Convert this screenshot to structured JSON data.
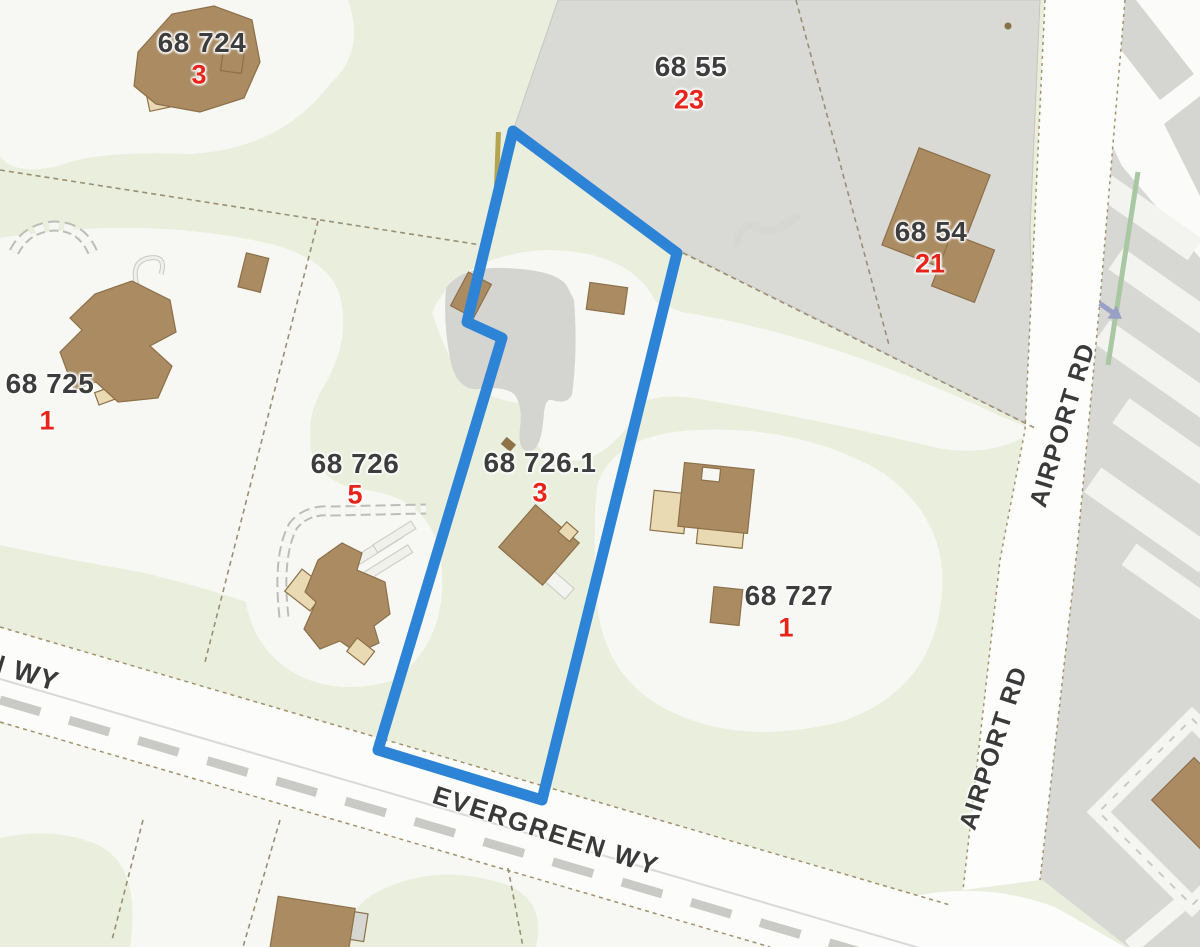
{
  "map": {
    "type": "cadastral-parcel-map",
    "selected_parcel": {
      "id": "68 726.1",
      "outline_color": "#2d84d6"
    },
    "parcels": [
      {
        "id": "68 724",
        "unit_count": "3"
      },
      {
        "id": "68 55",
        "unit_count": "23"
      },
      {
        "id": "68 54",
        "unit_count": "21"
      },
      {
        "id": "68 725",
        "unit_count": "1"
      },
      {
        "id": "68 726",
        "unit_count": "5"
      },
      {
        "id": "68 726.1",
        "unit_count": "3"
      },
      {
        "id": "68 727",
        "unit_count": "1"
      }
    ],
    "roads": [
      {
        "name": "AIRPORT RD"
      },
      {
        "name": "AIRPORT RD"
      },
      {
        "name": "EVERGREEN WY"
      },
      {
        "name": "N WY"
      }
    ],
    "icons": [
      {
        "name": "one-way-arrow-icon"
      }
    ],
    "colors": {
      "vegetation": "#e9efdc",
      "clearing": "#f7f8f3",
      "paved": "#d9d9d6",
      "road": "#fdfdfb",
      "building": "#aa8b62",
      "building_light": "#e9dab3",
      "selection_blue": "#2d84d6",
      "unit_count_red": "#e8231a",
      "label_dark": "#3d3d3d"
    }
  }
}
